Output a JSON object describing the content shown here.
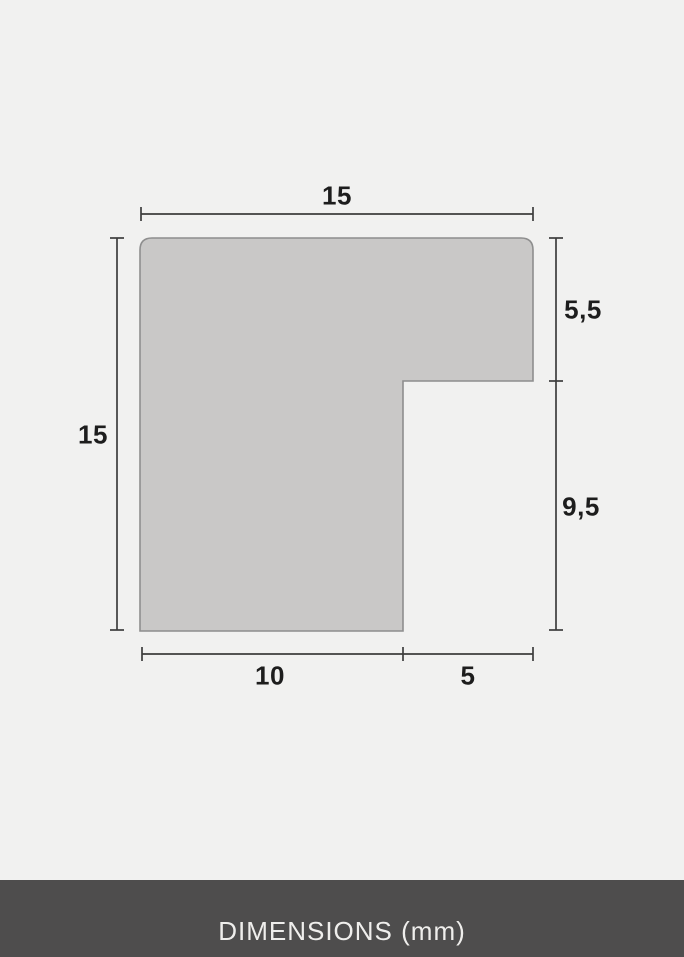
{
  "diagram": {
    "title": "frame moulding profile cross-section",
    "unit": "mm",
    "dimensions": {
      "top_width": "15",
      "left_height": "15",
      "right_upper_depth": "5,5",
      "right_lower_depth": "9,5",
      "bottom_left_width": "10",
      "bottom_right_width": "5"
    },
    "colors": {
      "background": "#f1f1f0",
      "shape_fill": "#c9c8c7",
      "shape_border": "#8e8e8e",
      "dimension_line": "#3d3d3d",
      "label_text": "#1d1d1d"
    }
  },
  "footer": {
    "label": "DIMENSIONS (mm)",
    "background": "#4e4d4d",
    "text_color": "#efeeec"
  }
}
